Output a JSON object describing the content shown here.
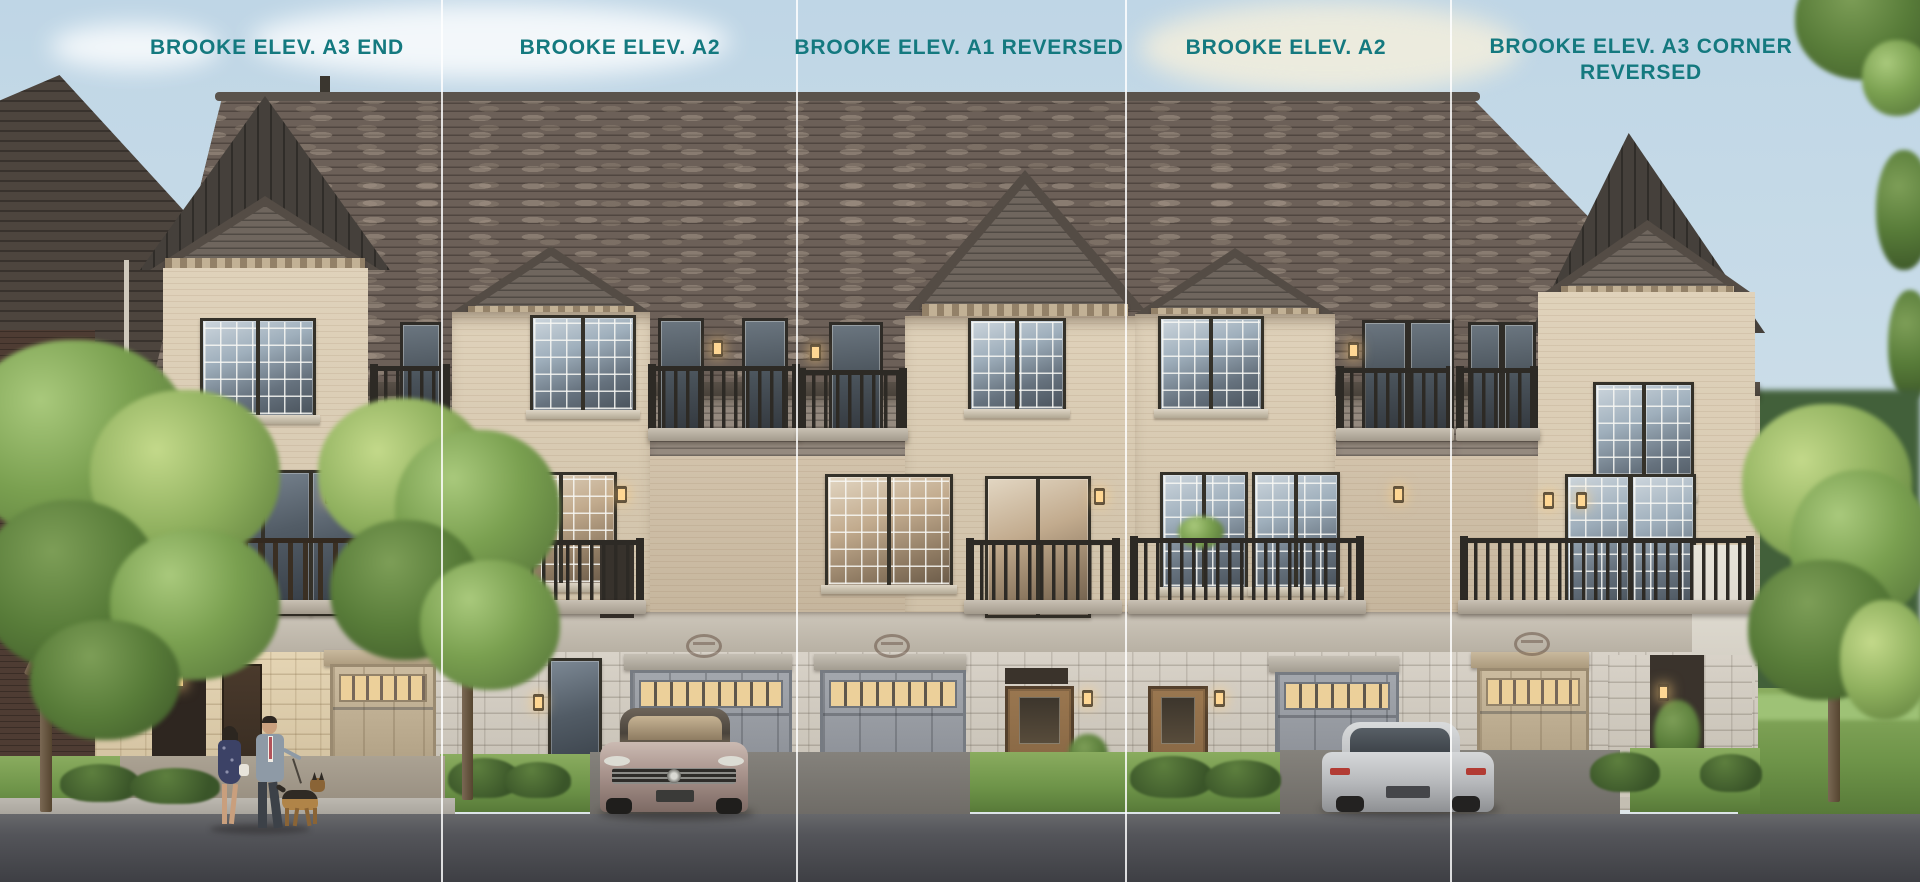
{
  "page": {
    "type": "architectural elevation rendering",
    "project_name": "BROOKE",
    "units_shown": 5,
    "storeys": 3
  },
  "labels": [
    {
      "text": "BROOKE ELEV. A3 END"
    },
    {
      "text": "BROOKE ELEV. A2"
    },
    {
      "text": "BROOKE ELEV. A1 REVERSED"
    },
    {
      "text": "BROOKE ELEV. A2"
    },
    {
      "text": "BROOKE ELEV. A3 CORNER REVERSED"
    }
  ],
  "theme": {
    "label_color": "#14797f",
    "divider_color": "#ffffff",
    "sky_color": "#c9dce8",
    "roof_shingle_color": "#6c6058",
    "brick_color": "#d2c1a7",
    "stone_color": "#d0cac0",
    "garage_gray_color": "#979ba1",
    "garage_tan_color": "#c2b199",
    "railing_color": "#2d2a25",
    "grass_color": "#7da356",
    "road_color": "#4a4b4f"
  },
  "scene": {
    "objects": [
      "townhouse-row",
      "gabled-roofs",
      "balconies-with-railings",
      "garage-doors",
      "entry-doors",
      "wall-lanterns",
      "stone-veneer-base",
      "brick-facade",
      "parked-sedan-front-view",
      "parked-sedan-rear-view",
      "couple-walking",
      "german-shepherd-dog",
      "street-trees",
      "shrubs",
      "lawn",
      "driveways",
      "sidewalk",
      "road",
      "sky-with-clouds"
    ]
  }
}
